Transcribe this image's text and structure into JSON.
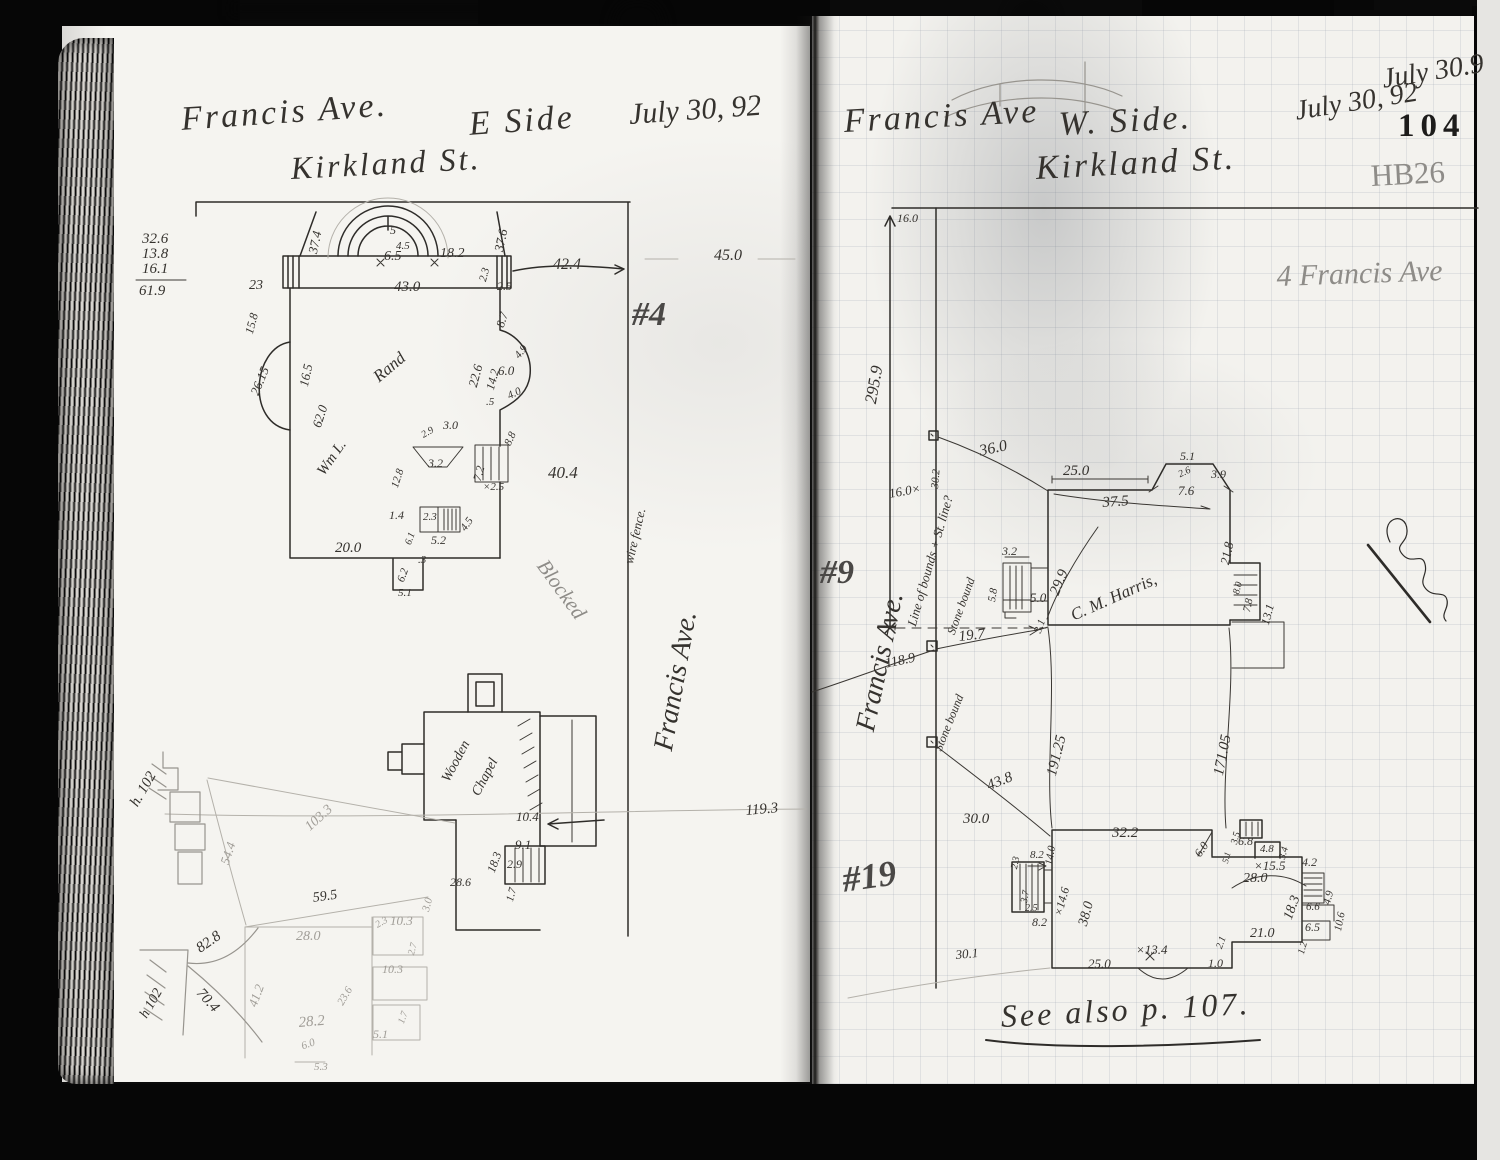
{
  "palette": {
    "paper": "#f5f3ef",
    "ink": "#35322e",
    "pencil": "#8e8c88",
    "grid_line": "#96a0ac",
    "scan_black": "#060606"
  },
  "header": {
    "left_title": "Francis Ave.",
    "left_side": "E Side",
    "left_date": "July 30, 92",
    "left_street": "Kirkland St.",
    "right_title": "Francis Ave",
    "right_side": "W. Side.",
    "right_street": "Kirkland St.",
    "right_date": "July 30, 92",
    "corner_date": "July 30.9",
    "page_number": "104",
    "book_ref": "HB26",
    "pencil_address": "4 Francis Ave"
  },
  "footer": {
    "see_also": "See also p. 107."
  },
  "labels": [
    {
      "n": "margin-sum-1",
      "t": "32.6",
      "x": 142,
      "y": 232,
      "fs": 15
    },
    {
      "n": "margin-sum-2",
      "t": "13.8",
      "x": 142,
      "y": 247,
      "fs": 15
    },
    {
      "n": "margin-sum-3",
      "t": "16.1",
      "x": 142,
      "y": 262,
      "fs": 15
    },
    {
      "n": "margin-sum-total",
      "t": "61.9",
      "x": 139,
      "y": 284,
      "fs": 15
    },
    {
      "n": "dim",
      "t": "37.4",
      "x": 306,
      "y": 252,
      "fs": 13,
      "r": -78
    },
    {
      "n": "dim",
      "t": "5",
      "x": 390,
      "y": 224,
      "fs": 12
    },
    {
      "n": "dim",
      "t": "4.5",
      "x": 396,
      "y": 241,
      "fs": 11
    },
    {
      "n": "dim",
      "t": "6.5",
      "x": 384,
      "y": 250,
      "fs": 14
    },
    {
      "n": "dim",
      "t": "18.2",
      "x": 440,
      "y": 247,
      "fs": 14
    },
    {
      "n": "dim",
      "t": "43.0",
      "x": 394,
      "y": 280,
      "fs": 15
    },
    {
      "n": "dim",
      "t": "37.6",
      "x": 492,
      "y": 250,
      "fs": 13,
      "r": -78
    },
    {
      "n": "dim",
      "t": "2.3",
      "x": 478,
      "y": 280,
      "fs": 11,
      "r": -75
    },
    {
      "n": "dim",
      "t": "2.5",
      "x": 497,
      "y": 280,
      "fs": 12
    },
    {
      "n": "dim",
      "t": "23",
      "x": 249,
      "y": 279,
      "fs": 14
    },
    {
      "n": "dim",
      "t": "15.8",
      "x": 243,
      "y": 332,
      "fs": 12,
      "r": -75
    },
    {
      "n": "dim",
      "t": "42.4",
      "x": 553,
      "y": 257,
      "fs": 16
    },
    {
      "n": "dim",
      "t": "45.0",
      "x": 714,
      "y": 248,
      "fs": 16
    },
    {
      "n": "lot-number-4",
      "t": "#4",
      "x": 632,
      "y": 298,
      "fs": 34,
      "c": "pend"
    },
    {
      "n": "dim",
      "t": "26.15",
      "x": 248,
      "y": 392,
      "fs": 13,
      "r": -68
    },
    {
      "n": "dim",
      "t": "16.5",
      "x": 297,
      "y": 385,
      "fs": 13,
      "r": -78
    },
    {
      "n": "dim",
      "t": "62.0",
      "x": 310,
      "y": 425,
      "fs": 13,
      "r": -72
    },
    {
      "n": "owner-name-left-1",
      "t": "Wm L.",
      "x": 315,
      "y": 470,
      "fs": 15,
      "r": -55
    },
    {
      "n": "owner-name-left-2",
      "t": "Rand",
      "x": 370,
      "y": 372,
      "fs": 17,
      "r": -40
    },
    {
      "n": "dim",
      "t": "22.6",
      "x": 466,
      "y": 385,
      "fs": 13,
      "r": -75
    },
    {
      "n": "dim",
      "t": "8.7",
      "x": 494,
      "y": 325,
      "fs": 12,
      "r": -72
    },
    {
      "n": "dim",
      "t": "14.2",
      "x": 484,
      "y": 388,
      "fs": 12,
      "r": -75
    },
    {
      "n": "dim",
      "t": "6.0",
      "x": 498,
      "y": 364,
      "fs": 13
    },
    {
      "n": "dim",
      "t": "4.9",
      "x": 513,
      "y": 354,
      "fs": 11,
      "r": -50
    },
    {
      "n": "dim",
      "t": "4.0",
      "x": 506,
      "y": 392,
      "fs": 11,
      "r": -25
    },
    {
      "n": "dim",
      "t": ".5",
      "x": 486,
      "y": 397,
      "fs": 11
    },
    {
      "n": "dim",
      "t": "8.8",
      "x": 503,
      "y": 443,
      "fs": 11,
      "r": -65
    },
    {
      "n": "dim",
      "t": "3.0",
      "x": 443,
      "y": 419,
      "fs": 12
    },
    {
      "n": "dim",
      "t": "2.9",
      "x": 420,
      "y": 432,
      "fs": 10,
      "r": -30
    },
    {
      "n": "dim",
      "t": "3.2",
      "x": 428,
      "y": 457,
      "fs": 12
    },
    {
      "n": "dim",
      "t": "12.8",
      "x": 390,
      "y": 486,
      "fs": 11,
      "r": -72
    },
    {
      "n": "dim",
      "t": "7.2",
      "x": 471,
      "y": 479,
      "fs": 12,
      "r": -75
    },
    {
      "n": "dim",
      "t": "×2.5",
      "x": 483,
      "y": 482,
      "fs": 11
    },
    {
      "n": "dim",
      "t": "40.4",
      "x": 548,
      "y": 464,
      "fs": 17
    },
    {
      "n": "dim",
      "t": "1.4",
      "x": 389,
      "y": 509,
      "fs": 12
    },
    {
      "n": "dim",
      "t": "6.1",
      "x": 404,
      "y": 543,
      "fs": 10,
      "r": -70
    },
    {
      "n": "dim",
      "t": "2.3",
      "x": 423,
      "y": 512,
      "fs": 11
    },
    {
      "n": "dim",
      "t": "5.2",
      "x": 431,
      "y": 534,
      "fs": 12
    },
    {
      "n": "dim",
      "t": "4.5",
      "x": 459,
      "y": 527,
      "fs": 11,
      "r": -55
    },
    {
      "n": "dim",
      "t": "20.0",
      "x": 335,
      "y": 541,
      "fs": 15
    },
    {
      "n": "dim",
      "t": "6.2",
      "x": 396,
      "y": 580,
      "fs": 11,
      "r": -70
    },
    {
      "n": "dim",
      "t": ".3",
      "x": 418,
      "y": 555,
      "fs": 11
    },
    {
      "n": "dim",
      "t": "5.1",
      "x": 398,
      "y": 588,
      "fs": 11
    },
    {
      "n": "fence-note",
      "t": "wire fence.",
      "x": 622,
      "y": 562,
      "fs": 13,
      "r": -77
    },
    {
      "n": "street-label-left",
      "t": "Francis Ave.",
      "x": 650,
      "y": 748,
      "fs": 28,
      "r": -80
    },
    {
      "n": "blocked-note",
      "t": "Blocked",
      "x": 550,
      "y": 556,
      "fs": 21,
      "r": 54,
      "c": "pencil"
    },
    {
      "n": "building-label-1",
      "t": "Wooden",
      "x": 440,
      "y": 778,
      "fs": 14,
      "r": -62
    },
    {
      "n": "building-label-2",
      "t": "Chapel",
      "x": 470,
      "y": 792,
      "fs": 14,
      "r": -62
    },
    {
      "n": "dim",
      "t": "10.4",
      "x": 516,
      "y": 810,
      "fs": 13
    },
    {
      "n": "dim",
      "t": "18.3",
      "x": 485,
      "y": 870,
      "fs": 12,
      "r": -70
    },
    {
      "n": "dim",
      "t": "9.1",
      "x": 515,
      "y": 838,
      "fs": 13
    },
    {
      "n": "dim",
      "t": "2.9",
      "x": 507,
      "y": 858,
      "fs": 12
    },
    {
      "n": "dim",
      "t": "1.7",
      "x": 505,
      "y": 900,
      "fs": 11,
      "r": -75
    },
    {
      "n": "dim",
      "t": "28.6",
      "x": 450,
      "y": 876,
      "fs": 12
    },
    {
      "n": "dim",
      "t": "119.3",
      "x": 745,
      "y": 804,
      "fs": 15,
      "r": -5
    },
    {
      "n": "ref-note",
      "t": "h. 102",
      "x": 128,
      "y": 802,
      "fs": 15,
      "r": -60
    },
    {
      "n": "dim",
      "t": "54.4",
      "x": 218,
      "y": 862,
      "fs": 13,
      "r": -72,
      "c": "faint"
    },
    {
      "n": "dim",
      "t": "103.3",
      "x": 303,
      "y": 824,
      "fs": 14,
      "r": -42,
      "c": "faint"
    },
    {
      "n": "dim",
      "t": "59.5",
      "x": 312,
      "y": 892,
      "fs": 14,
      "r": -8
    },
    {
      "n": "dim",
      "t": "28.0",
      "x": 296,
      "y": 930,
      "fs": 14,
      "c": "faint"
    },
    {
      "n": "dim",
      "t": "2.3",
      "x": 374,
      "y": 922,
      "fs": 10,
      "r": -30,
      "c": "faint"
    },
    {
      "n": "dim",
      "t": "10.3",
      "x": 390,
      "y": 914,
      "fs": 13,
      "c": "faint"
    },
    {
      "n": "dim",
      "t": "3.0",
      "x": 421,
      "y": 910,
      "fs": 11,
      "r": -75,
      "c": "faint"
    },
    {
      "n": "dim",
      "t": "2.7",
      "x": 407,
      "y": 954,
      "fs": 10,
      "r": -75,
      "c": "faint"
    },
    {
      "n": "dim",
      "t": "41.2",
      "x": 246,
      "y": 1004,
      "fs": 13,
      "r": -70,
      "c": "faint"
    },
    {
      "n": "dim",
      "t": "82.8",
      "x": 194,
      "y": 944,
      "fs": 15,
      "r": -35
    },
    {
      "n": "dim",
      "t": "70.4",
      "x": 204,
      "y": 986,
      "fs": 15,
      "r": 48
    },
    {
      "n": "ref-note",
      "t": "h 102",
      "x": 138,
      "y": 1014,
      "fs": 14,
      "r": -60
    },
    {
      "n": "dim",
      "t": "28.2",
      "x": 298,
      "y": 1016,
      "fs": 15,
      "r": -5,
      "c": "faint"
    },
    {
      "n": "dim",
      "t": "23.6",
      "x": 336,
      "y": 1002,
      "fs": 11,
      "r": -60,
      "c": "faint"
    },
    {
      "n": "dim",
      "t": "10.3",
      "x": 382,
      "y": 963,
      "fs": 12,
      "c": "faint"
    },
    {
      "n": "dim",
      "t": "5.1",
      "x": 373,
      "y": 1028,
      "fs": 12,
      "c": "faint"
    },
    {
      "n": "dim",
      "t": "1.7",
      "x": 397,
      "y": 1022,
      "fs": 10,
      "r": -70,
      "c": "faint"
    },
    {
      "n": "dim",
      "t": "6.0",
      "x": 300,
      "y": 1042,
      "fs": 11,
      "r": -20,
      "c": "faint"
    },
    {
      "n": "dim",
      "t": "5.3",
      "x": 314,
      "y": 1062,
      "fs": 11,
      "c": "faint"
    },
    {
      "n": "dim",
      "t": "16.0",
      "x": 897,
      "y": 212,
      "fs": 12
    },
    {
      "n": "dim",
      "t": "295.9",
      "x": 862,
      "y": 402,
      "fs": 17,
      "r": -80
    },
    {
      "n": "boundary-note",
      "t": "Line of bounds + St. line?",
      "x": 905,
      "y": 624,
      "fs": 13,
      "r": -74
    },
    {
      "n": "dim",
      "t": "30.2",
      "x": 930,
      "y": 488,
      "fs": 11,
      "r": -85
    },
    {
      "n": "dim",
      "t": "16.0×",
      "x": 888,
      "y": 487,
      "fs": 13,
      "r": -10
    },
    {
      "n": "dim",
      "t": "36.0",
      "x": 978,
      "y": 444,
      "fs": 16,
      "r": -12
    },
    {
      "n": "dim",
      "t": "25.0",
      "x": 1063,
      "y": 464,
      "fs": 15
    },
    {
      "n": "dim",
      "t": "37.5",
      "x": 1102,
      "y": 496,
      "fs": 15,
      "r": -4
    },
    {
      "n": "dim",
      "t": "29.9",
      "x": 1048,
      "y": 592,
      "fs": 15,
      "r": -68
    },
    {
      "n": "owner-name-right",
      "t": "C. M. Harris,",
      "x": 1068,
      "y": 608,
      "fs": 17,
      "r": -24
    },
    {
      "n": "dim",
      "t": "5.1",
      "x": 1180,
      "y": 450,
      "fs": 12
    },
    {
      "n": "dim",
      "t": "2.6",
      "x": 1177,
      "y": 471,
      "fs": 10,
      "r": -25
    },
    {
      "n": "dim",
      "t": "3.9",
      "x": 1211,
      "y": 468,
      "fs": 12
    },
    {
      "n": "dim",
      "t": "7.6",
      "x": 1178,
      "y": 484,
      "fs": 13
    },
    {
      "n": "dim",
      "t": "21.8",
      "x": 1218,
      "y": 563,
      "fs": 13,
      "r": -78
    },
    {
      "n": "dim",
      "t": "8.0",
      "x": 1232,
      "y": 593,
      "fs": 10,
      "r": -75
    },
    {
      "n": "dim",
      "t": "7.8",
      "x": 1242,
      "y": 611,
      "fs": 11,
      "r": -78
    },
    {
      "n": "dim",
      "t": "13.1",
      "x": 1259,
      "y": 623,
      "fs": 12,
      "r": -75
    },
    {
      "n": "dim",
      "t": "3.2",
      "x": 1002,
      "y": 545,
      "fs": 12
    },
    {
      "n": "dim",
      "t": "5.8",
      "x": 987,
      "y": 601,
      "fs": 11,
      "r": -80
    },
    {
      "n": "dim",
      "t": "5.0",
      "x": 1030,
      "y": 591,
      "fs": 13
    },
    {
      "n": "dim",
      "t": "3.1",
      "x": 1033,
      "y": 631,
      "fs": 11,
      "r": -70
    },
    {
      "n": "dim",
      "t": "19.7",
      "x": 958,
      "y": 630,
      "fs": 15,
      "r": -6
    },
    {
      "n": "dim",
      "t": "118.9",
      "x": 884,
      "y": 658,
      "fs": 14,
      "r": -12
    },
    {
      "n": "bound-note",
      "t": "Stone bound",
      "x": 945,
      "y": 632,
      "fs": 12,
      "r": -70
    },
    {
      "n": "bound-note",
      "t": "Stone bound",
      "x": 932,
      "y": 748,
      "fs": 12,
      "r": -68
    },
    {
      "n": "street-label-right",
      "t": "Francis Ave.",
      "x": 852,
      "y": 728,
      "fs": 28,
      "r": -78
    },
    {
      "n": "dim",
      "t": "191.25",
      "x": 1045,
      "y": 774,
      "fs": 15,
      "r": -76
    },
    {
      "n": "dim",
      "t": "171.05",
      "x": 1212,
      "y": 774,
      "fs": 15,
      "r": -79
    },
    {
      "n": "dim",
      "t": "43.8",
      "x": 985,
      "y": 780,
      "fs": 15,
      "r": -22
    },
    {
      "n": "dim",
      "t": "30.0",
      "x": 963,
      "y": 812,
      "fs": 15
    },
    {
      "n": "dim",
      "t": "14.0",
      "x": 1044,
      "y": 864,
      "fs": 11,
      "r": -80
    },
    {
      "n": "dim",
      "t": "32.2",
      "x": 1112,
      "y": 826,
      "fs": 15
    },
    {
      "n": "dim",
      "t": "30.1",
      "x": 955,
      "y": 948,
      "fs": 13,
      "r": -5
    },
    {
      "n": "lot-number-9",
      "t": "#9",
      "x": 820,
      "y": 556,
      "fs": 34,
      "c": "pend"
    },
    {
      "n": "lot-number-19",
      "t": "#19",
      "x": 840,
      "y": 862,
      "fs": 36,
      "r": -8,
      "c": "pend"
    },
    {
      "n": "dim",
      "t": "2.3",
      "x": 1010,
      "y": 868,
      "fs": 10,
      "r": -78
    },
    {
      "n": "dim",
      "t": "8.2",
      "x": 1030,
      "y": 850,
      "fs": 11
    },
    {
      "n": "dim",
      "t": "3.7",
      "x": 1020,
      "y": 902,
      "fs": 10,
      "r": -80
    },
    {
      "n": "dim",
      "t": "2.5",
      "x": 1025,
      "y": 904,
      "fs": 10
    },
    {
      "n": "dim",
      "t": "8.2",
      "x": 1032,
      "y": 916,
      "fs": 12
    },
    {
      "n": "dim",
      "t": "×14.6",
      "x": 1052,
      "y": 914,
      "fs": 12,
      "r": -75
    },
    {
      "n": "dim",
      "t": "38.0",
      "x": 1077,
      "y": 924,
      "fs": 14,
      "r": -75
    },
    {
      "n": "dim",
      "t": "6.0",
      "x": 1192,
      "y": 852,
      "fs": 12,
      "r": -55
    },
    {
      "n": "dim",
      "t": "3.5",
      "x": 1230,
      "y": 843,
      "fs": 10,
      "r": -75
    },
    {
      "n": "dim",
      "t": "5.1",
      "x": 1221,
      "y": 862,
      "fs": 9,
      "r": -75
    },
    {
      "n": "dim",
      "t": "6.8",
      "x": 1238,
      "y": 835,
      "fs": 12
    },
    {
      "n": "dim",
      "t": "4.8",
      "x": 1260,
      "y": 844,
      "fs": 11
    },
    {
      "n": "dim",
      "t": "3.4",
      "x": 1278,
      "y": 858,
      "fs": 10,
      "r": -75
    },
    {
      "n": "dim",
      "t": "×15.5",
      "x": 1254,
      "y": 859,
      "fs": 13
    },
    {
      "n": "dim",
      "t": "28.0",
      "x": 1243,
      "y": 872,
      "fs": 14
    },
    {
      "n": "dim",
      "t": "4.2",
      "x": 1302,
      "y": 856,
      "fs": 12
    },
    {
      "n": "dim",
      "t": "18.3",
      "x": 1282,
      "y": 917,
      "fs": 14,
      "r": -70
    },
    {
      "n": "dim",
      "t": "6.6",
      "x": 1306,
      "y": 902,
      "fs": 11
    },
    {
      "n": "dim",
      "t": "4.9",
      "x": 1322,
      "y": 903,
      "fs": 11,
      "r": -75
    },
    {
      "n": "dim",
      "t": "10.6",
      "x": 1333,
      "y": 930,
      "fs": 11,
      "r": -78
    },
    {
      "n": "dim",
      "t": "6.5",
      "x": 1305,
      "y": 921,
      "fs": 12
    },
    {
      "n": "dim",
      "t": "1.2",
      "x": 1297,
      "y": 953,
      "fs": 10,
      "r": -75
    },
    {
      "n": "dim",
      "t": "21.0",
      "x": 1250,
      "y": 927,
      "fs": 14
    },
    {
      "n": "dim",
      "t": "2.1",
      "x": 1215,
      "y": 947,
      "fs": 10,
      "r": -70
    },
    {
      "n": "dim",
      "t": "1.0",
      "x": 1208,
      "y": 957,
      "fs": 12
    },
    {
      "n": "dim",
      "t": "×13.4",
      "x": 1136,
      "y": 943,
      "fs": 13
    },
    {
      "n": "dim",
      "t": "25.0",
      "x": 1088,
      "y": 957,
      "fs": 13
    }
  ]
}
